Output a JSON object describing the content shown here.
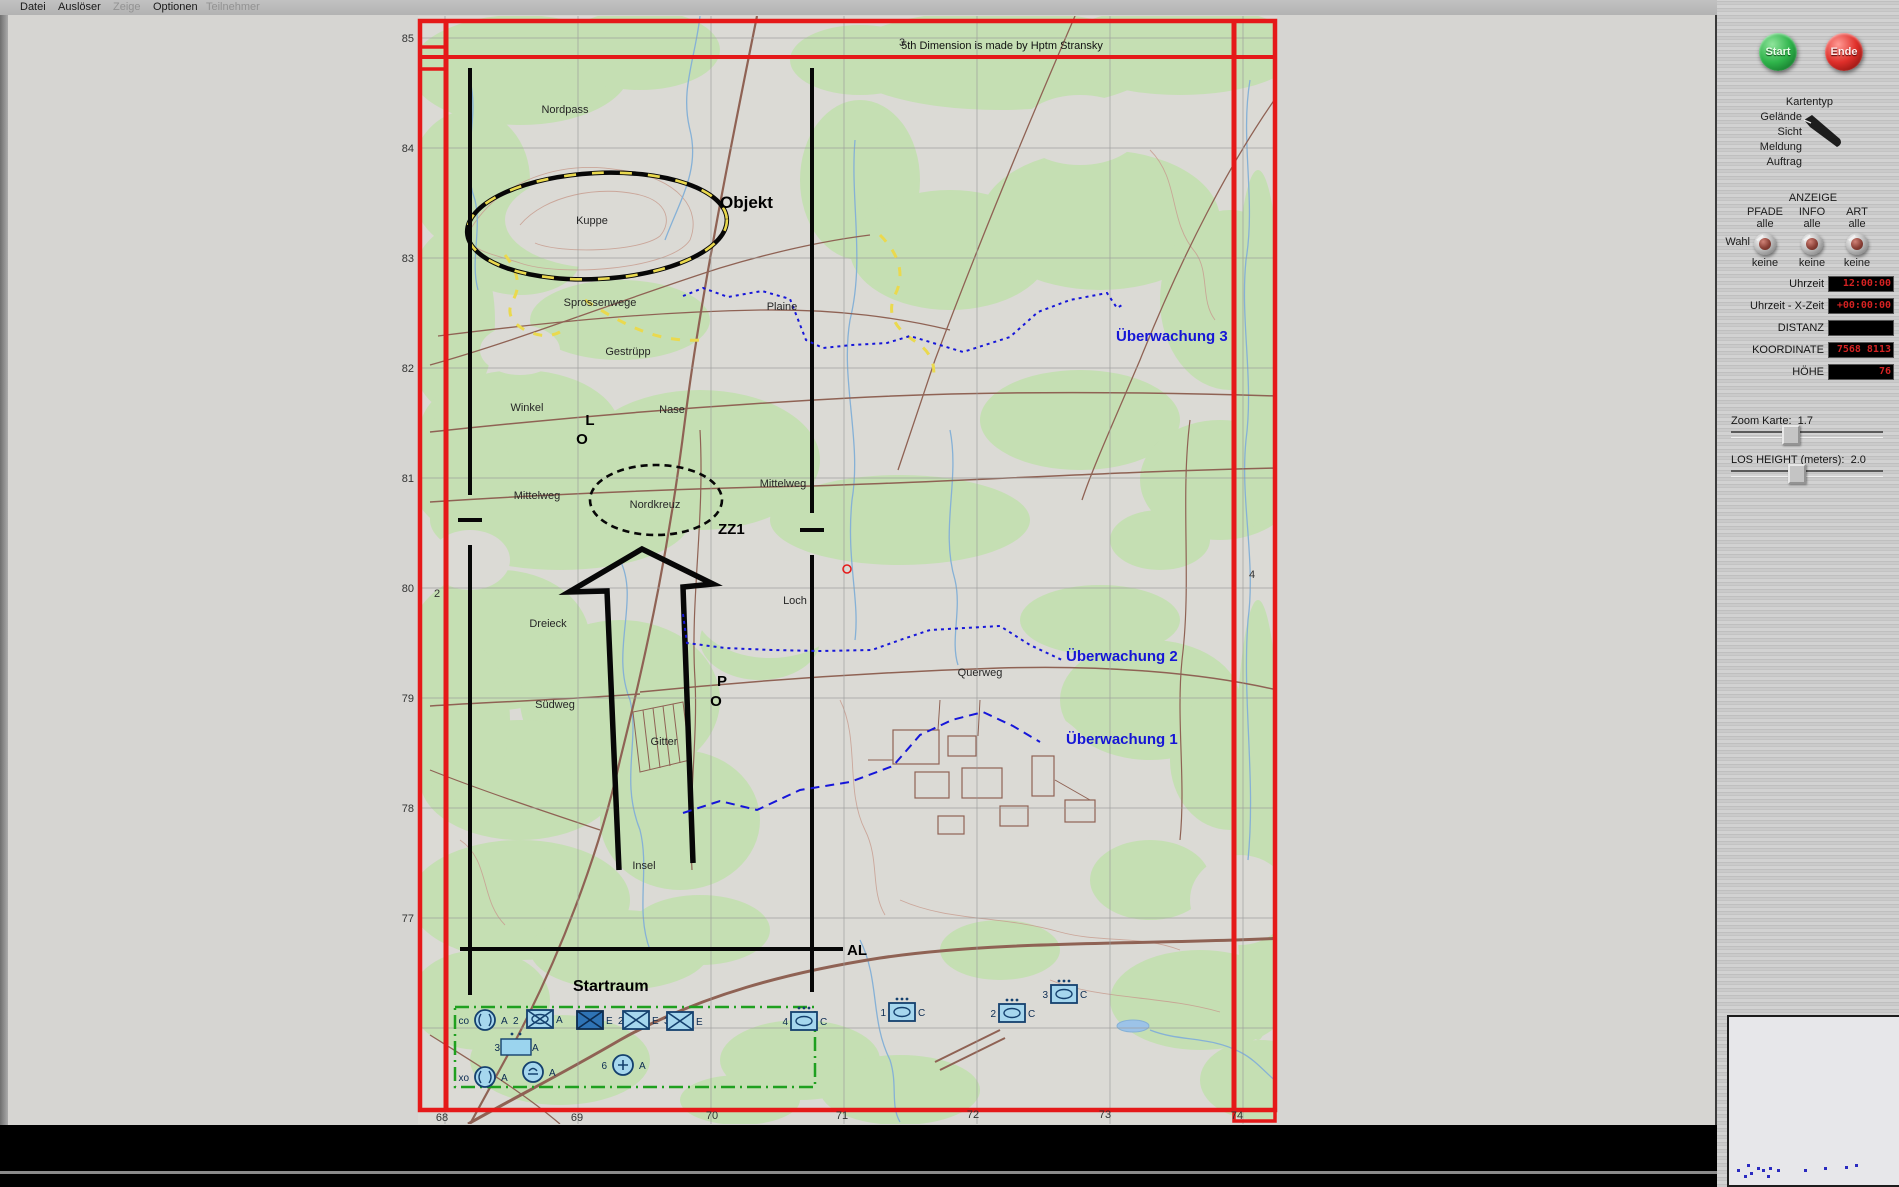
{
  "menu": {
    "items": [
      {
        "label": "Datei",
        "enabled": true,
        "x": 20
      },
      {
        "label": "Auslöser",
        "enabled": true,
        "x": 58
      },
      {
        "label": "Zeige",
        "enabled": false,
        "x": 113
      },
      {
        "label": "Optionen",
        "enabled": true,
        "x": 153
      },
      {
        "label": "Teilnehmer",
        "enabled": false,
        "x": 206
      }
    ]
  },
  "map": {
    "credit": "5th Dimension is made by Hptm Stransky",
    "labels": [
      {
        "t": "5th Dimension is made by Hptm Stransky",
        "x": 1002,
        "y": 49,
        "c": "credit"
      },
      {
        "t": "Nordpass",
        "x": 565,
        "y": 113,
        "c": "terr"
      },
      {
        "t": "Kuppe",
        "x": 592,
        "y": 224,
        "c": "terr"
      },
      {
        "t": "Sprossenwege",
        "x": 600,
        "y": 306,
        "c": "terr"
      },
      {
        "t": "Plaine",
        "x": 782,
        "y": 310,
        "c": "terr"
      },
      {
        "t": "Gestrüpp",
        "x": 628,
        "y": 355,
        "c": "terr"
      },
      {
        "t": "Winkel",
        "x": 527,
        "y": 411,
        "c": "terr"
      },
      {
        "t": "Nase",
        "x": 672,
        "y": 413,
        "c": "terr"
      },
      {
        "t": "Mittelweg",
        "x": 537,
        "y": 499,
        "c": "terr"
      },
      {
        "t": "Nordkreuz",
        "x": 655,
        "y": 508,
        "c": "terr"
      },
      {
        "t": "Mittelweg",
        "x": 783,
        "y": 487,
        "c": "terr"
      },
      {
        "t": "Loch",
        "x": 795,
        "y": 604,
        "c": "terr"
      },
      {
        "t": "Dreieck",
        "x": 548,
        "y": 627,
        "c": "terr"
      },
      {
        "t": "Südweg",
        "x": 555,
        "y": 708,
        "c": "terr"
      },
      {
        "t": "Gitter",
        "x": 664,
        "y": 745,
        "c": "terr"
      },
      {
        "t": "Querweg",
        "x": 980,
        "y": 676,
        "c": "terr"
      },
      {
        "t": "Insel",
        "x": 644,
        "y": 869,
        "c": "terr"
      },
      {
        "t": "Objekt",
        "x": 720,
        "y": 208,
        "c": "obj",
        "a": "start"
      },
      {
        "t": "L",
        "x": 590,
        "y": 425,
        "c": "bb"
      },
      {
        "t": "O",
        "x": 582,
        "y": 444,
        "c": "bb"
      },
      {
        "t": "ZZ1",
        "x": 718,
        "y": 534,
        "c": "bb",
        "a": "start"
      },
      {
        "t": "P",
        "x": 722,
        "y": 686,
        "c": "bb"
      },
      {
        "t": "O",
        "x": 716,
        "y": 706,
        "c": "bb"
      },
      {
        "t": "Startraum",
        "x": 573,
        "y": 991,
        "c": "st",
        "a": "start"
      },
      {
        "t": "AL",
        "x": 847,
        "y": 955,
        "c": "bb",
        "a": "start"
      },
      {
        "t": "Überwachung 3",
        "x": 1116,
        "y": 341,
        "c": "blue",
        "a": "start"
      },
      {
        "t": "Überwachung 2",
        "x": 1066,
        "y": 661,
        "c": "blue",
        "a": "start"
      },
      {
        "t": "Überwachung 1",
        "x": 1066,
        "y": 744,
        "c": "blue",
        "a": "start"
      },
      {
        "t": "85",
        "x": 414,
        "y": 42,
        "c": "grid",
        "a": "end"
      },
      {
        "t": "84",
        "x": 414,
        "y": 152,
        "c": "grid",
        "a": "end"
      },
      {
        "t": "83",
        "x": 414,
        "y": 262,
        "c": "grid",
        "a": "end"
      },
      {
        "t": "82",
        "x": 414,
        "y": 372,
        "c": "grid",
        "a": "end"
      },
      {
        "t": "81",
        "x": 414,
        "y": 482,
        "c": "grid",
        "a": "end"
      },
      {
        "t": "80",
        "x": 414,
        "y": 592,
        "c": "grid",
        "a": "end"
      },
      {
        "t": "79",
        "x": 414,
        "y": 702,
        "c": "grid",
        "a": "end"
      },
      {
        "t": "78",
        "x": 414,
        "y": 812,
        "c": "grid",
        "a": "end"
      },
      {
        "t": "77",
        "x": 414,
        "y": 922,
        "c": "grid",
        "a": "end"
      },
      {
        "t": "68",
        "x": 442,
        "y": 1121,
        "c": "grid"
      },
      {
        "t": "69",
        "x": 577,
        "y": 1121,
        "c": "grid"
      },
      {
        "t": "70",
        "x": 712,
        "y": 1119,
        "c": "grid"
      },
      {
        "t": "71",
        "x": 842,
        "y": 1119,
        "c": "grid"
      },
      {
        "t": "72",
        "x": 973,
        "y": 1118,
        "c": "grid"
      },
      {
        "t": "73",
        "x": 1105,
        "y": 1118,
        "c": "grid"
      },
      {
        "t": "74",
        "x": 1237,
        "y": 1119,
        "c": "grid"
      },
      {
        "t": "3",
        "x": 902,
        "y": 46,
        "c": "grid"
      },
      {
        "t": "2",
        "x": 437,
        "y": 597,
        "c": "grid"
      },
      {
        "t": "4",
        "x": 1252,
        "y": 578,
        "c": "grid"
      }
    ],
    "units": [
      {
        "type": "circle",
        "x": 485,
        "y": 1020,
        "left": "co",
        "right": "A",
        "extra": "2"
      },
      {
        "type": "mech",
        "x": 540,
        "y": 1019,
        "right": "A"
      },
      {
        "type": "boxx_dark",
        "x": 590,
        "y": 1020,
        "right": "E",
        "extra": "2"
      },
      {
        "type": "boxx",
        "x": 636,
        "y": 1020,
        "right": "E",
        "extra": "3"
      },
      {
        "type": "boxx",
        "x": 680,
        "y": 1021,
        "right": "E"
      },
      {
        "type": "recon",
        "x": 804,
        "y": 1021,
        "left": "4",
        "right": "C"
      },
      {
        "type": "hq",
        "x": 516,
        "y": 1047,
        "left": "3",
        "right": "A"
      },
      {
        "type": "circle",
        "x": 485,
        "y": 1077,
        "left": "xo",
        "right": "A"
      },
      {
        "type": "circle_arc",
        "x": 533,
        "y": 1072,
        "right": "A"
      },
      {
        "type": "circle_plus",
        "x": 623,
        "y": 1065,
        "left": "6",
        "right": "A"
      },
      {
        "type": "recon",
        "x": 902,
        "y": 1012,
        "left": "1",
        "right": "C"
      },
      {
        "type": "recon",
        "x": 1012,
        "y": 1013,
        "left": "2",
        "right": "C"
      },
      {
        "type": "recon",
        "x": 1064,
        "y": 994,
        "left": "3",
        "right": "C"
      }
    ]
  },
  "sidebar": {
    "start_label": "Start",
    "end_label": "Ende",
    "kartentyp_title": "Kartentyp",
    "kartentyp_options": [
      {
        "label": "Gelände",
        "selected": true
      },
      {
        "label": "Sicht",
        "selected": false
      },
      {
        "label": "Meldung",
        "selected": false
      },
      {
        "label": "Auftrag",
        "selected": false
      }
    ],
    "anzeige_title": "ANZEIGE",
    "wahl_label": "Wahl",
    "knobs": [
      {
        "name": "PFADE",
        "top": "alle",
        "bottom": "keine"
      },
      {
        "name": "INFO",
        "top": "alle",
        "bottom": "keine"
      },
      {
        "name": "ART",
        "top": "alle",
        "bottom": "keine"
      }
    ],
    "displays": [
      {
        "label": "Uhrzeit",
        "value": "12:00:00"
      },
      {
        "label": "Uhrzeit - X-Zeit",
        "value": "+00:00:00"
      },
      {
        "label": "DISTANZ",
        "value": ""
      },
      {
        "label": "KOORDINATE",
        "value": "7568 8113"
      },
      {
        "label": "HÖHE",
        "value": "76"
      }
    ],
    "sliders": [
      {
        "label": "Zoom Karte:",
        "value": "1.7",
        "pos": 0.37
      },
      {
        "label": "LOS HEIGHT (meters):",
        "value": "2.0",
        "pos": 0.41
      }
    ],
    "minimap_dots": [
      [
        8,
        152
      ],
      [
        15,
        158
      ],
      [
        21,
        155
      ],
      [
        18,
        147
      ],
      [
        28,
        150
      ],
      [
        33,
        152
      ],
      [
        40,
        150
      ],
      [
        48,
        152
      ],
      [
        38,
        158
      ],
      [
        75,
        152
      ],
      [
        95,
        150
      ],
      [
        116,
        149
      ],
      [
        126,
        147
      ]
    ]
  }
}
